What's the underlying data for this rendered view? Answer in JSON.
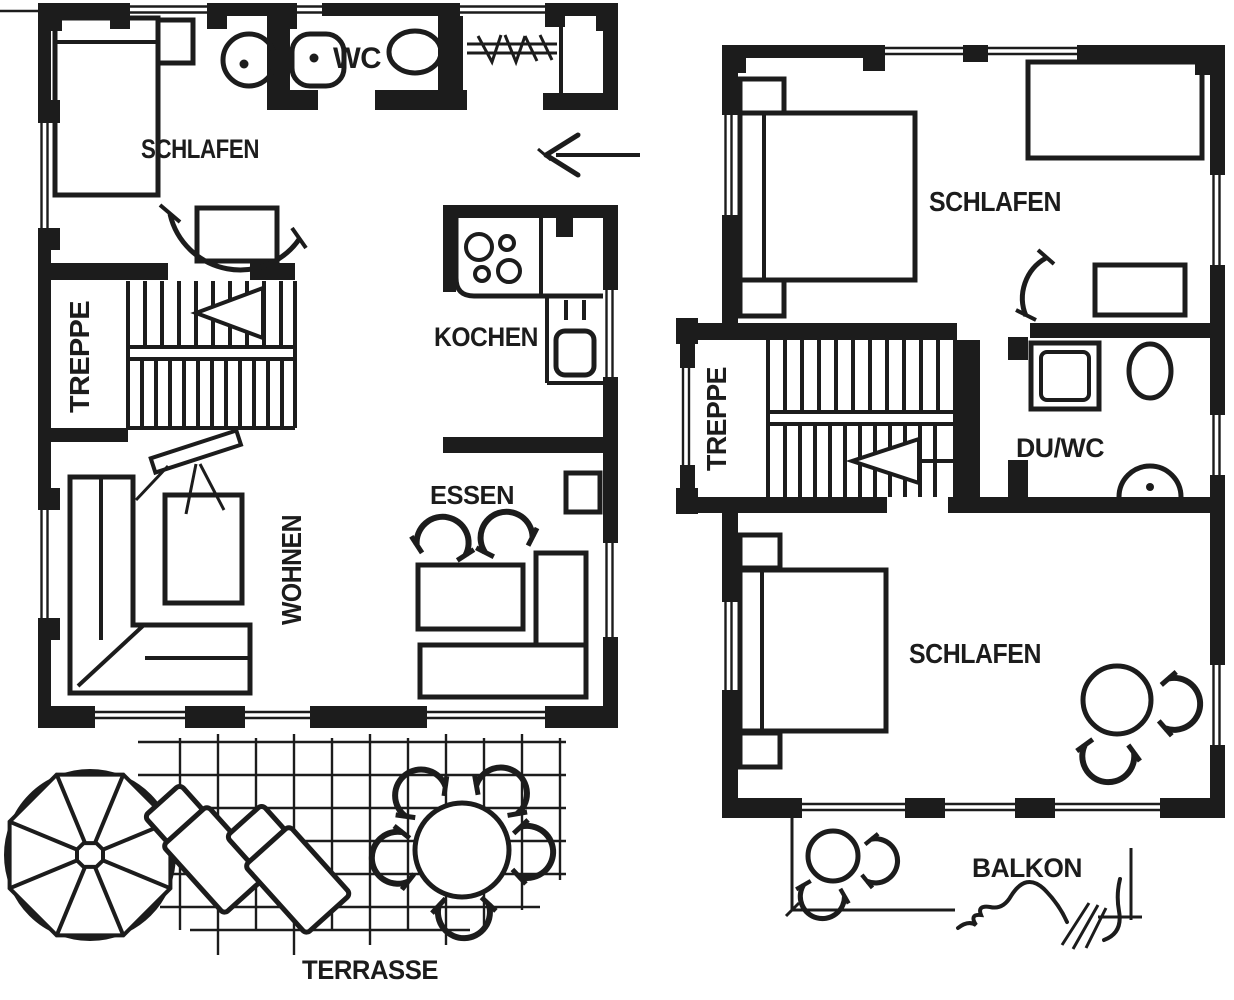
{
  "colors": {
    "ink": "#1c1c1c",
    "paper": "#ffffff"
  },
  "ground_floor": {
    "schlafen": "SCHLAFEN",
    "wc": "WC",
    "treppe": "TREPPE",
    "kochen": "KOCHEN",
    "essen": "ESSEN",
    "wohnen": "WOHNEN",
    "terrasse": "TERRASSE"
  },
  "upper_floor": {
    "schlafen_top": "SCHLAFEN",
    "treppe": "TREPPE",
    "du_wc": "DU/WC",
    "schlafen_bottom": "SCHLAFEN",
    "balkon": "BALKON"
  }
}
